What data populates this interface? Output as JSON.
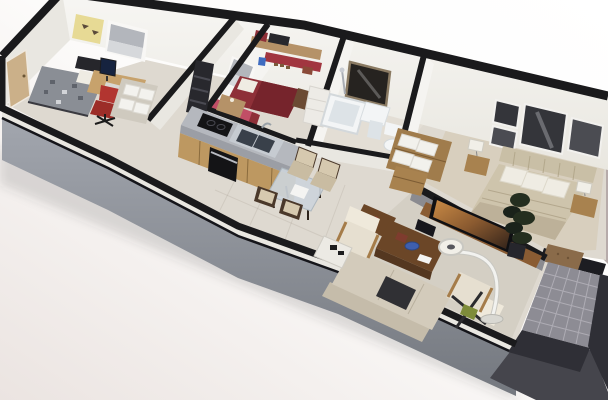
{
  "scene": {
    "title": "3D cutaway floor plan render of an apartment (no visible text)",
    "view": "axonometric dollhouse cutaway seen from above, rotated diagonally",
    "rooms": [
      {
        "name": "office-guest-room",
        "items": [
          "single bed with gray patterned duvet",
          "dark headboard",
          "desk with computer monitor",
          "red office chair",
          "shelf unit with white storage boxes",
          "yellow wall art",
          "window with gray roller blind",
          "entry door"
        ]
      },
      {
        "name": "hallway",
        "items": [
          "dark coat-rack panel",
          "beige tile floor"
        ]
      },
      {
        "name": "kids-room",
        "items": [
          "red single bed with white pillow",
          "wall shelf with red and black boxes",
          "red wall stripe",
          "blue and rust wall decals",
          "window with gray roller blind",
          "pink accent wall",
          "corner desk",
          "white wardrobe"
        ]
      },
      {
        "name": "kitchen",
        "items": [
          "gray countertop",
          "wood cabinet fronts",
          "black glass cooktop",
          "black oven",
          "double stainless sink with faucet"
        ]
      },
      {
        "name": "dining-area",
        "items": [
          "glass dining table",
          "four dark-wood chairs with beige upholstery"
        ]
      },
      {
        "name": "bathroom",
        "items": [
          "bathtub",
          "shower fixture",
          "pedestal sink",
          "dark framed mirror",
          "toilet"
        ]
      },
      {
        "name": "linen-nook",
        "items": [
          "wood cabinet stacked with white towels"
        ]
      },
      {
        "name": "master-bedroom",
        "items": [
          "double bed with tan duvet",
          "woven headboard",
          "white pillows",
          "two wood nightstands with lamps",
          "three black-and-white framed pictures",
          "small wood cabinet"
        ]
      },
      {
        "name": "living-room",
        "items": [
          "beige sofa with dark throw",
          "two beige armchairs with wood arms",
          "dark wood coffee table with blue bowl",
          "side table with black decor",
          "TV on wood console",
          "white arc floor lamp",
          "tall dark plant",
          "magazine rack with green item"
        ]
      },
      {
        "name": "balcony",
        "items": [
          "gray tile grid floor",
          "dark parapet walls",
          "brown doormat"
        ]
      }
    ]
  },
  "palette": {
    "background_top": "#ffffff",
    "background_bottom": "#ebe4e1",
    "wall_cap": "#1a1a1c",
    "wall_face": "#f5f4f1",
    "wall_face_side": "#e9e7e1",
    "divider_gray": "#8b8b90",
    "slab_trim": "#15151a",
    "slab_pink": "#b6abaa",
    "slab_dark": "#45454c",
    "parapet_dark": "#2f2f36",
    "floor_tile": "#ded9d0",
    "floor_bath": "#e3ded5",
    "floor_carpet": "#d8cfbe",
    "floor_living": "#d4cfc4",
    "balcony_tile": "#8d8c94",
    "balcony_grid": "#aeacb4",
    "mat_brown": "#8a6b4a",
    "threshold_dark": "#1d1d22",
    "door_tan": "#cbb089",
    "art_yellow": "#e7da95",
    "blind_gray": "#b3b6bc",
    "blind_light": "#d6d8db",
    "office_duvet": "#8a8e95",
    "office_headboard": "#26262b",
    "desk_wood": "#c7a26c",
    "chair_red": "#b23530",
    "chair_red_dark": "#9c2d28",
    "monitor_navy": "#16233f",
    "box_white": "#f3f2ee",
    "coatrack_dark": "#28282d",
    "kids_bed_red": "#8e3038",
    "kids_bed_dark": "#76242c",
    "kids_pink": "#c14e66",
    "kids_shelf_red": "#a13640",
    "kids_frame_brown": "#6b4a33",
    "shelf_wood": "#b59268",
    "decal_blue": "#3f6cc0",
    "decal_rust": "#8a4a38",
    "wardrobe_white": "#edebe6",
    "counter_gray": "#b5b8be",
    "counter_edge": "#9b9ea5",
    "cabinet_wood": "#bd9861",
    "appliance_black": "#141416",
    "sink_steel": "#c6cbd1",
    "basin_dark": "#39404a",
    "glass_table": "#ccd4da",
    "chair_wood": "#4a382a",
    "chair_beige": "#d6c9af",
    "chair_beige_dark": "#c9bca2",
    "fixture_white": "#f3f5f6",
    "fixture_shade": "#dde3e7",
    "mirror_dark": "#262320",
    "mirror_frame": "#8a7a62",
    "towel_wood": "#a07c4c",
    "towel_white": "#f2f1ec",
    "duvet_tan": "#cec4ac",
    "duvet_tan_dark": "#bdb199",
    "pillow_white": "#efece3",
    "headboard_weave": "#c9bfa6",
    "nightstand_wood": "#a8824f",
    "lamp_white": "#f1efe8",
    "picture_dark": "#34353a",
    "picture_mid": "#4b4c52",
    "console_wood": "#8a5c33",
    "tv_black": "#101013",
    "sofa_beige": "#d3cbbb",
    "sofa_back": "#c5bcaa",
    "armchair_beige": "#e6dfd0",
    "armchair_light": "#efe9db",
    "armchair_wood": "#a57c49",
    "table_dark": "#6b4627",
    "table_dark_side": "#543720",
    "throw_dark": "#303034",
    "plant_green": "#242e1f",
    "plant_dark": "#1a221a",
    "lamp_arc": "#f2f2ef",
    "lamp_base": "#d9d8d2",
    "bowl_blue": "#3e5fae",
    "rack_dark": "#2b2b2e",
    "rack_green": "#7e8c3a"
  }
}
